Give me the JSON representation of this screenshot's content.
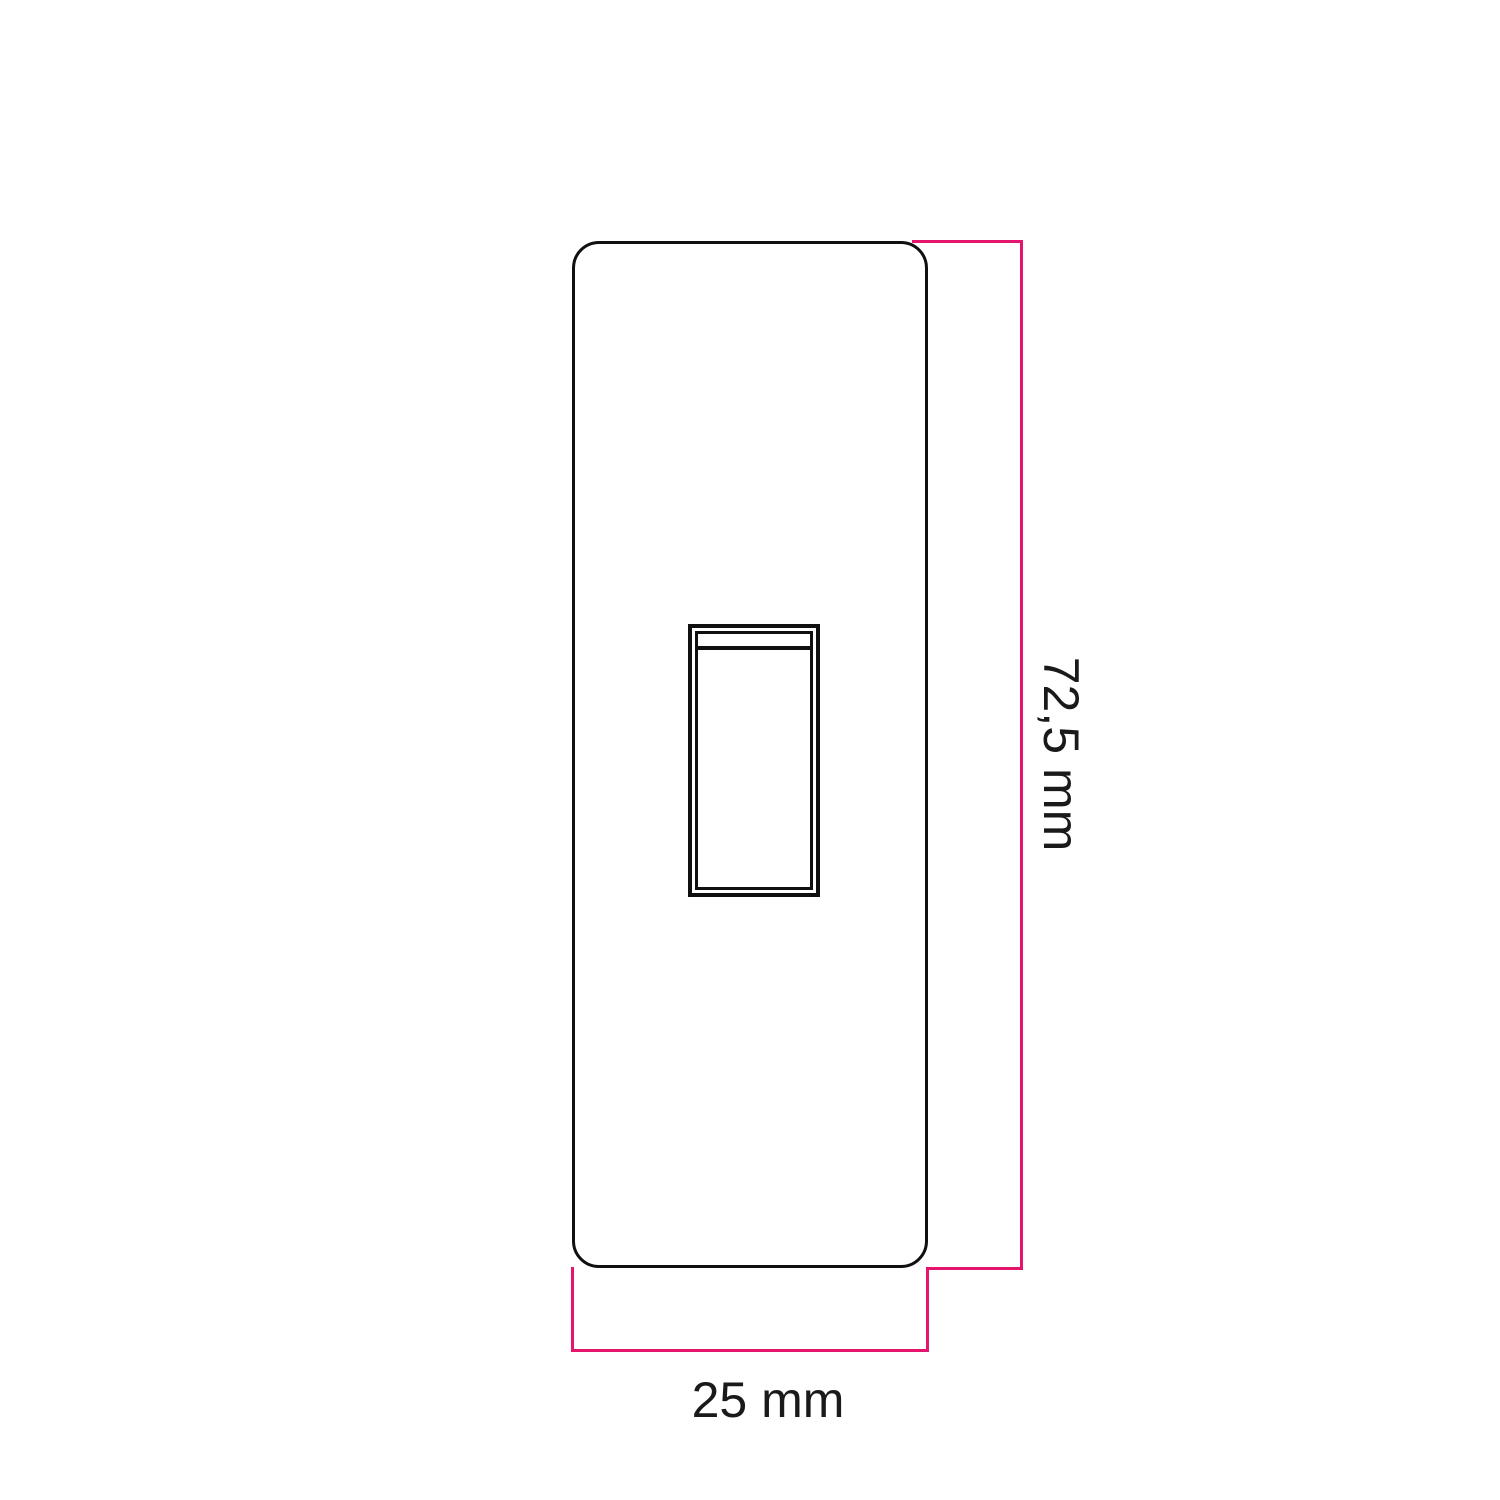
{
  "drawing": {
    "labels": {
      "height": "72,5 mm",
      "width": "25 mm"
    },
    "colors": {
      "dimension_line": "#E5146D",
      "outline": "#101010",
      "text": "#1A1A1A"
    }
  }
}
